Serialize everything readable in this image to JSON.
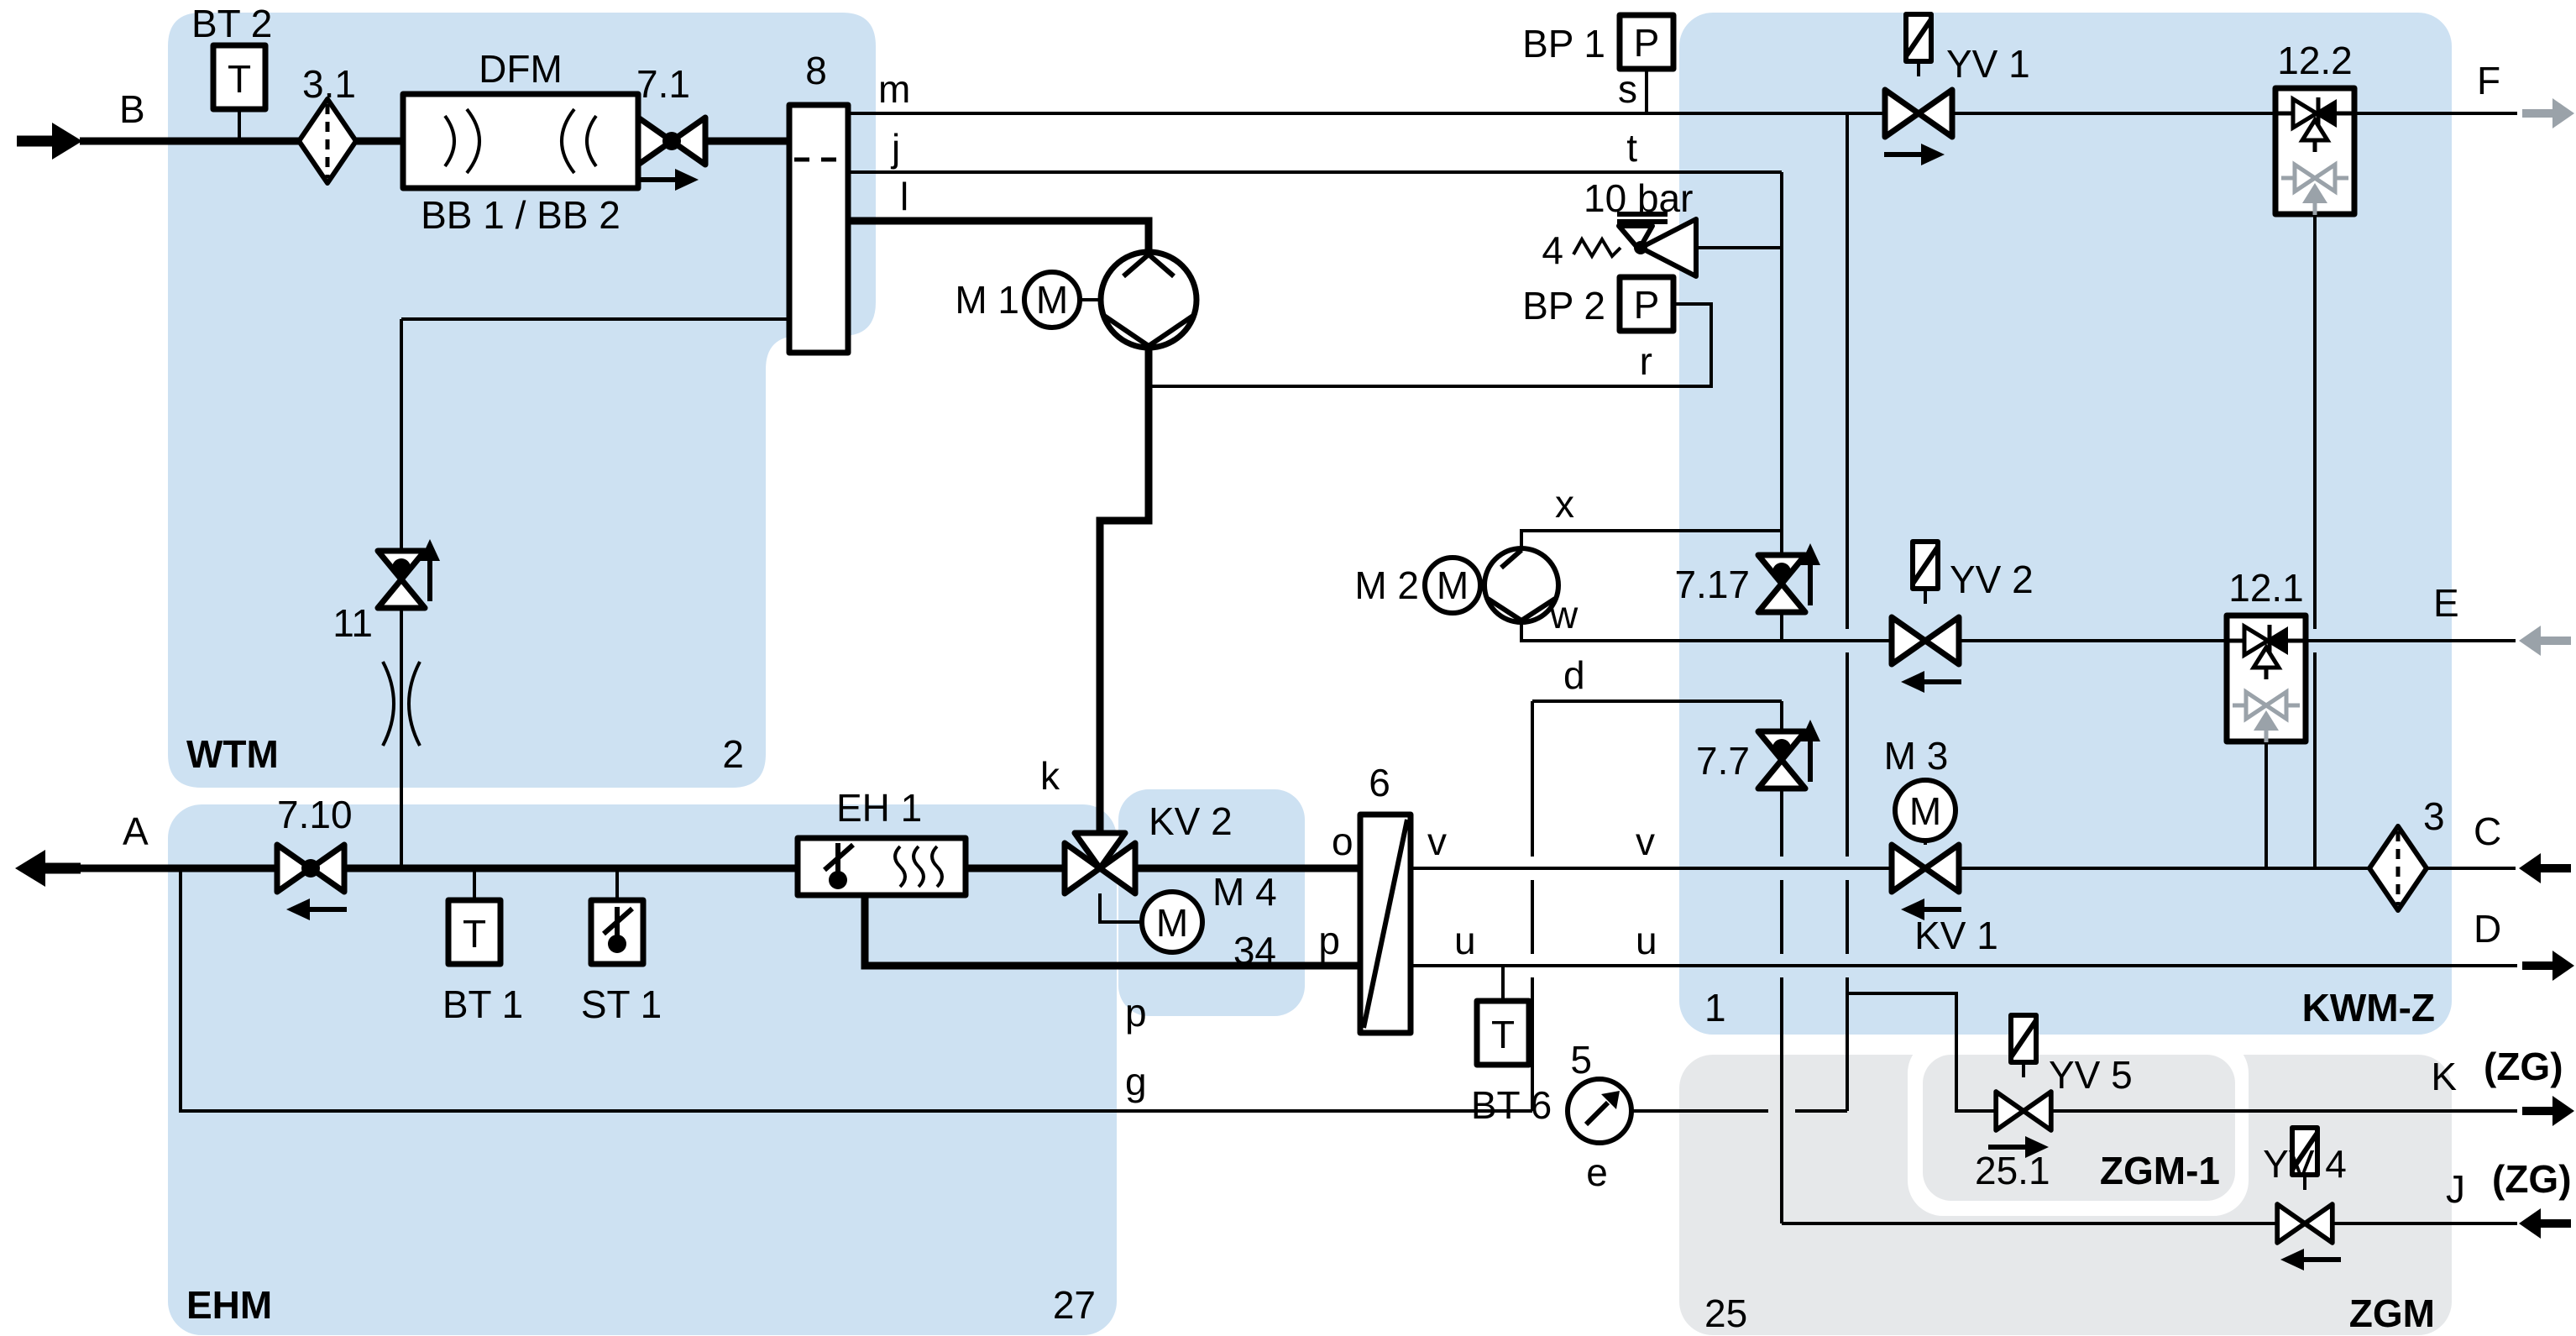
{
  "colors": {
    "region_blue": "#cde1f2",
    "region_gray": "#e6e8ea",
    "line": "#000000",
    "muted_arrow": "#9aa2a9"
  },
  "regions": {
    "wtm": {
      "label": "WTM",
      "number": "2"
    },
    "ehm": {
      "label": "EHM",
      "number": "27"
    },
    "kwmz": {
      "label": "KWM-Z",
      "number": "1"
    },
    "zgm": {
      "label": "ZGM",
      "number": "25"
    },
    "zgm1": {
      "label": "ZGM-1",
      "number": "25.1"
    }
  },
  "ports": {
    "a": "A",
    "b": "B",
    "c": "C",
    "d": "D",
    "e": "E",
    "f": "F",
    "j": "J",
    "k": "K",
    "zg_k": "(ZG)",
    "zg_j": "(ZG)"
  },
  "components": {
    "bt2": {
      "label": "BT 2",
      "symbol": "T"
    },
    "bt1": {
      "label": "BT 1",
      "symbol": "T"
    },
    "bt6": {
      "label": "BT 6",
      "symbol": "T"
    },
    "st1": {
      "label": "ST 1"
    },
    "filter_31": {
      "label": "3.1"
    },
    "filter_3": {
      "label": "3"
    },
    "dfm": {
      "label": "DFM",
      "sublabel": "BB 1 / BB 2"
    },
    "valve_71": {
      "label": "7.1"
    },
    "valve_710": {
      "label": "7.10"
    },
    "valve_11": {
      "label": "11"
    },
    "valve_717": {
      "label": "7.17"
    },
    "valve_77": {
      "label": "7.7"
    },
    "relief_4": {
      "label": "4",
      "rating": "10 bar"
    },
    "vessel_8": {
      "label": "8"
    },
    "hx_6": {
      "label": "6"
    },
    "eh1": {
      "label": "EH 1"
    },
    "kv1": {
      "label": "KV 1"
    },
    "kv2": {
      "label": "KV 2"
    },
    "m1": {
      "label": "M 1",
      "symbol": "M"
    },
    "m2": {
      "label": "M 2",
      "symbol": "M"
    },
    "m3": {
      "label": "M 3",
      "symbol": "M"
    },
    "m4": {
      "label": "M 4",
      "symbol": "M",
      "number": "34"
    },
    "bp1": {
      "label": "BP 1",
      "symbol": "P"
    },
    "bp2": {
      "label": "BP 2",
      "symbol": "P"
    },
    "gauge_5": {
      "label": "5"
    },
    "yv1": {
      "label": "YV 1"
    },
    "yv2": {
      "label": "YV 2"
    },
    "yv4": {
      "label": "YV 4"
    },
    "yv5": {
      "label": "YV 5"
    },
    "check_122": {
      "label": "12.2"
    },
    "check_121": {
      "label": "12.1"
    }
  },
  "lines": {
    "m": "m",
    "j": "j",
    "l": "l",
    "s": "s",
    "t": "t",
    "r": "r",
    "x": "x",
    "w": "w",
    "d": "d",
    "k": "k",
    "e": "e",
    "g": "g",
    "o": "o",
    "v1": "v",
    "v2": "v",
    "u1": "u",
    "u2": "u",
    "p1": "p",
    "p2": "p"
  }
}
